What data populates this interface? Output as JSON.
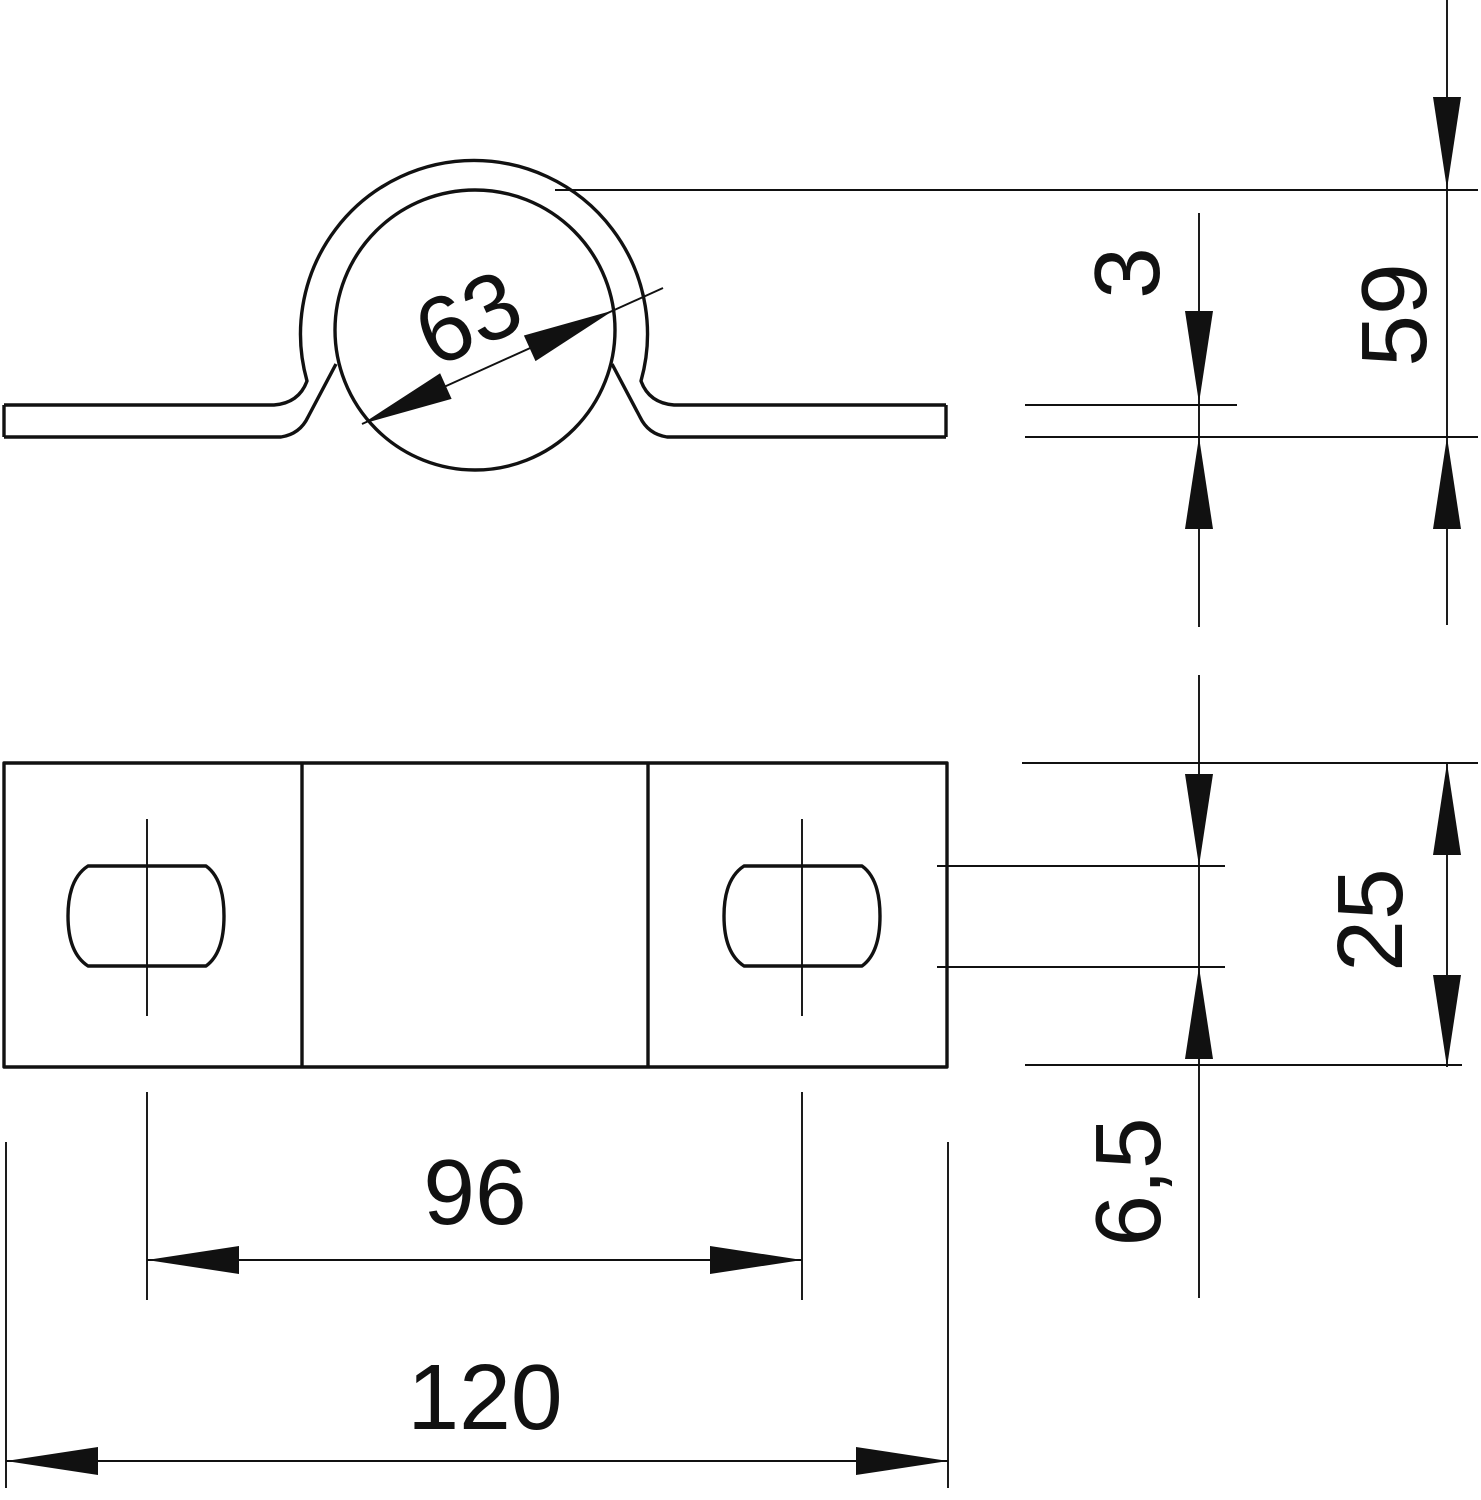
{
  "canvas": {
    "background": "#ffffff",
    "line_color": "#111111"
  },
  "dimensions": {
    "pipe_diameter": "63",
    "material_thickness": "3",
    "overall_height": "59",
    "clamp_width": "25",
    "slot_width": "6,5",
    "slot_spacing": "96",
    "overall_length": "120"
  }
}
